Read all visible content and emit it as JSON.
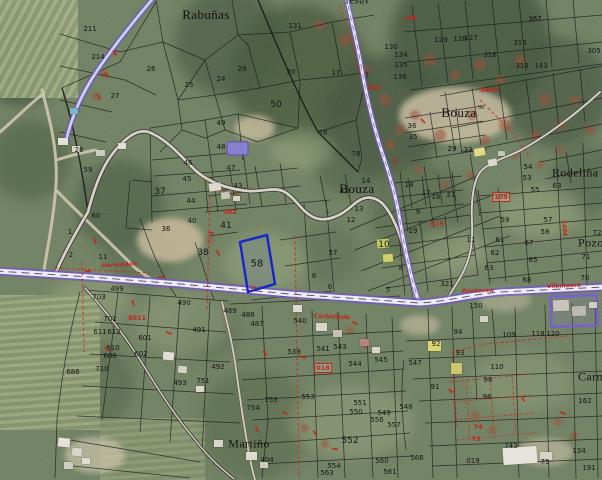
{
  "map": {
    "colors": {
      "road_purple": "#6f55c9",
      "road_fill": "#efeafc",
      "selection_blue": "#1526cc",
      "annotation_red": "#c42318",
      "parcel_line": "#1c1c1c",
      "highlight_fill": "#8b7fd6"
    },
    "place_labels": [
      {
        "t": "Rabuñas",
        "x": 206,
        "y": 15,
        "s": 13
      },
      {
        "t": "Bouza",
        "x": 459,
        "y": 113,
        "s": 13
      },
      {
        "t": "Bouza",
        "x": 357,
        "y": 189,
        "s": 13
      },
      {
        "t": "Rodeliña",
        "x": 552,
        "y": 173,
        "s": 12,
        "a": "l"
      },
      {
        "t": "Pozo",
        "x": 578,
        "y": 243,
        "s": 12,
        "a": "l"
      },
      {
        "t": "Carnés",
        "x": 578,
        "y": 377,
        "s": 12,
        "a": "l"
      },
      {
        "t": "Martiño",
        "x": 249,
        "y": 444,
        "s": 12
      },
      {
        "t": "Tesuv",
        "x": 344,
        "y": 1,
        "s": 10,
        "a": "l"
      }
    ],
    "superscripts": [
      {
        "t": "39",
        "x": 481,
        "y": 108
      }
    ],
    "parcel_numbers": [
      {
        "t": "211",
        "x": 90,
        "y": 29
      },
      {
        "t": "214",
        "x": 98,
        "y": 57
      },
      {
        "t": "26",
        "x": 151,
        "y": 69
      },
      {
        "t": "27",
        "x": 115,
        "y": 96
      },
      {
        "t": "28",
        "x": 79,
        "y": 150
      },
      {
        "t": "59",
        "x": 88,
        "y": 170
      },
      {
        "t": "60",
        "x": 96,
        "y": 216
      },
      {
        "t": "1",
        "x": 70,
        "y": 232
      },
      {
        "t": "2",
        "x": 71,
        "y": 255
      },
      {
        "t": "11",
        "x": 103,
        "y": 257
      },
      {
        "t": "25",
        "x": 189,
        "y": 85
      },
      {
        "t": "24",
        "x": 221,
        "y": 79
      },
      {
        "t": "29",
        "x": 242,
        "y": 69
      },
      {
        "t": "20",
        "x": 291,
        "y": 72
      },
      {
        "t": "17",
        "x": 336,
        "y": 73
      },
      {
        "t": "131",
        "x": 295,
        "y": 26
      },
      {
        "t": "50",
        "x": 276,
        "y": 105,
        "s": 9
      },
      {
        "t": "49",
        "x": 221,
        "y": 123
      },
      {
        "t": "48",
        "x": 221,
        "y": 147
      },
      {
        "t": "76",
        "x": 323,
        "y": 133
      },
      {
        "t": "78",
        "x": 356,
        "y": 154
      },
      {
        "t": "46",
        "x": 188,
        "y": 163
      },
      {
        "t": "45",
        "x": 187,
        "y": 179
      },
      {
        "t": "47",
        "x": 231,
        "y": 168
      },
      {
        "t": "37",
        "x": 160,
        "y": 192,
        "s": 9
      },
      {
        "t": "44",
        "x": 191,
        "y": 201
      },
      {
        "t": "40",
        "x": 192,
        "y": 221
      },
      {
        "t": "36",
        "x": 166,
        "y": 229
      },
      {
        "t": "41",
        "x": 226,
        "y": 226,
        "s": 9
      },
      {
        "t": "42",
        "x": 344,
        "y": 191
      },
      {
        "t": "43",
        "x": 238,
        "y": 186
      },
      {
        "t": "38",
        "x": 203,
        "y": 253,
        "s": 9
      },
      {
        "t": "58",
        "x": 257,
        "y": 264,
        "s": 10
      },
      {
        "t": "57",
        "x": 333,
        "y": 253
      },
      {
        "t": "8",
        "x": 314,
        "y": 276
      },
      {
        "t": "6",
        "x": 330,
        "y": 287
      },
      {
        "t": "5",
        "x": 388,
        "y": 290
      },
      {
        "t": "8",
        "x": 401,
        "y": 268
      },
      {
        "t": "14",
        "x": 366,
        "y": 181
      },
      {
        "t": "13",
        "x": 359,
        "y": 209
      },
      {
        "t": "12",
        "x": 351,
        "y": 220
      },
      {
        "t": "18",
        "x": 409,
        "y": 185
      },
      {
        "t": "17",
        "x": 426,
        "y": 193
      },
      {
        "t": "16",
        "x": 436,
        "y": 197
      },
      {
        "t": "21",
        "x": 451,
        "y": 195
      },
      {
        "t": "9",
        "x": 418,
        "y": 212
      },
      {
        "t": "19",
        "x": 413,
        "y": 231
      },
      {
        "t": "10",
        "x": 384,
        "y": 245,
        "s": 9
      },
      {
        "t": "11",
        "x": 471,
        "y": 240
      },
      {
        "t": "36",
        "x": 412,
        "y": 126
      },
      {
        "t": "35",
        "x": 413,
        "y": 137
      },
      {
        "t": "33",
        "x": 468,
        "y": 150
      },
      {
        "t": "29",
        "x": 452,
        "y": 149
      },
      {
        "t": "54",
        "x": 528,
        "y": 167
      },
      {
        "t": "53",
        "x": 527,
        "y": 178
      },
      {
        "t": "367",
        "x": 535,
        "y": 19
      },
      {
        "t": "129",
        "x": 441,
        "y": 40
      },
      {
        "t": "128",
        "x": 460,
        "y": 39
      },
      {
        "t": "127",
        "x": 471,
        "y": 38
      },
      {
        "t": "315",
        "x": 520,
        "y": 43
      },
      {
        "t": "316",
        "x": 490,
        "y": 55
      },
      {
        "t": "314",
        "x": 522,
        "y": 66
      },
      {
        "t": "143",
        "x": 541,
        "y": 66
      },
      {
        "t": "305",
        "x": 594,
        "y": 51
      },
      {
        "t": "134",
        "x": 401,
        "y": 55
      },
      {
        "t": "135",
        "x": 401,
        "y": 65
      },
      {
        "t": "136",
        "x": 400,
        "y": 77
      },
      {
        "t": "130",
        "x": 391,
        "y": 47
      },
      {
        "t": "63",
        "x": 557,
        "y": 186
      },
      {
        "t": "55",
        "x": 535,
        "y": 190
      },
      {
        "t": "59",
        "x": 505,
        "y": 220
      },
      {
        "t": "57",
        "x": 548,
        "y": 220
      },
      {
        "t": "58",
        "x": 545,
        "y": 232
      },
      {
        "t": "61",
        "x": 500,
        "y": 240
      },
      {
        "t": "67",
        "x": 529,
        "y": 243
      },
      {
        "t": "62",
        "x": 495,
        "y": 253
      },
      {
        "t": "65",
        "x": 533,
        "y": 260
      },
      {
        "t": "63",
        "x": 489,
        "y": 268
      },
      {
        "t": "72",
        "x": 597,
        "y": 233
      },
      {
        "t": "71",
        "x": 586,
        "y": 257
      },
      {
        "t": "70",
        "x": 585,
        "y": 278
      },
      {
        "t": "68",
        "x": 527,
        "y": 280
      },
      {
        "t": "321",
        "x": 447,
        "y": 284
      },
      {
        "t": "150",
        "x": 476,
        "y": 306
      },
      {
        "t": "489",
        "x": 230,
        "y": 311
      },
      {
        "t": "488",
        "x": 248,
        "y": 315
      },
      {
        "t": "487",
        "x": 257,
        "y": 324
      },
      {
        "t": "490",
        "x": 184,
        "y": 303
      },
      {
        "t": "499",
        "x": 117,
        "y": 289
      },
      {
        "t": "491",
        "x": 199,
        "y": 330
      },
      {
        "t": "492",
        "x": 218,
        "y": 367
      },
      {
        "t": "493",
        "x": 180,
        "y": 383
      },
      {
        "t": "751",
        "x": 203,
        "y": 381
      },
      {
        "t": "753",
        "x": 271,
        "y": 400
      },
      {
        "t": "754",
        "x": 253,
        "y": 408
      },
      {
        "t": "703",
        "x": 99,
        "y": 297
      },
      {
        "t": "702",
        "x": 110,
        "y": 319
      },
      {
        "t": "611",
        "x": 100,
        "y": 332
      },
      {
        "t": "612",
        "x": 114,
        "y": 332
      },
      {
        "t": "610",
        "x": 113,
        "y": 348
      },
      {
        "t": "608",
        "x": 110,
        "y": 356
      },
      {
        "t": "601",
        "x": 145,
        "y": 338
      },
      {
        "t": "602",
        "x": 141,
        "y": 354
      },
      {
        "t": "686",
        "x": 73,
        "y": 372
      },
      {
        "t": "710",
        "x": 102,
        "y": 369
      },
      {
        "t": "540",
        "x": 300,
        "y": 321
      },
      {
        "t": "539",
        "x": 294,
        "y": 352
      },
      {
        "t": "541",
        "x": 323,
        "y": 349
      },
      {
        "t": "543",
        "x": 340,
        "y": 347
      },
      {
        "t": "544",
        "x": 355,
        "y": 364
      },
      {
        "t": "545",
        "x": 381,
        "y": 360
      },
      {
        "t": "553",
        "x": 308,
        "y": 397
      },
      {
        "t": "551",
        "x": 360,
        "y": 403
      },
      {
        "t": "550",
        "x": 356,
        "y": 412
      },
      {
        "t": "549",
        "x": 384,
        "y": 413
      },
      {
        "t": "556",
        "x": 377,
        "y": 420
      },
      {
        "t": "557",
        "x": 394,
        "y": 425
      },
      {
        "t": "552",
        "x": 350,
        "y": 441,
        "s": 9
      },
      {
        "t": "560",
        "x": 382,
        "y": 461
      },
      {
        "t": "561",
        "x": 390,
        "y": 472
      },
      {
        "t": "563",
        "x": 327,
        "y": 473
      },
      {
        "t": "554",
        "x": 334,
        "y": 466
      },
      {
        "t": "404",
        "x": 267,
        "y": 460
      },
      {
        "t": "566",
        "x": 417,
        "y": 458
      },
      {
        "t": "548",
        "x": 406,
        "y": 407
      },
      {
        "t": "547",
        "x": 415,
        "y": 363
      },
      {
        "t": "94",
        "x": 458,
        "y": 332
      },
      {
        "t": "92",
        "x": 436,
        "y": 344
      },
      {
        "t": "93",
        "x": 460,
        "y": 353
      },
      {
        "t": "91",
        "x": 435,
        "y": 387
      },
      {
        "t": "110",
        "x": 497,
        "y": 367
      },
      {
        "t": "98",
        "x": 488,
        "y": 380
      },
      {
        "t": "96",
        "x": 487,
        "y": 397
      },
      {
        "t": "109",
        "x": 509,
        "y": 335
      },
      {
        "t": "118",
        "x": 538,
        "y": 334
      },
      {
        "t": "120",
        "x": 553,
        "y": 334
      },
      {
        "t": "162",
        "x": 585,
        "y": 401
      },
      {
        "t": "134",
        "x": 579,
        "y": 451
      },
      {
        "t": "743",
        "x": 511,
        "y": 446
      },
      {
        "t": "019",
        "x": 473,
        "y": 461
      },
      {
        "t": "75",
        "x": 545,
        "y": 462
      },
      {
        "t": "191",
        "x": 589,
        "y": 468
      }
    ],
    "red_annotations": [
      {
        "t": "138",
        "x": 410,
        "y": 18
      },
      {
        "t": "9600",
        "x": 489,
        "y": 90
      },
      {
        "t": "150",
        "x": 374,
        "y": 88
      },
      {
        "t": "002",
        "x": 230,
        "y": 212
      },
      {
        "t": "015",
        "x": 437,
        "y": 224
      },
      {
        "t": "74",
        "x": 478,
        "y": 427
      },
      {
        "t": "73",
        "x": 476,
        "y": 439
      },
      {
        "t": "5011",
        "x": 137,
        "y": 318
      }
    ],
    "red_boxed_annotations": [
      {
        "t": "018",
        "x": 323,
        "y": 368
      },
      {
        "t": "109",
        "x": 501,
        "y": 197
      }
    ],
    "road_labels": [
      {
        "t": "Hermedelo",
        "x": 120,
        "y": 265,
        "r": -3
      },
      {
        "t": "Carballeda",
        "x": 332,
        "y": 317,
        "r": 2
      },
      {
        "t": "Pontevea",
        "x": 478,
        "y": 291,
        "r": -2
      },
      {
        "t": "Vilamoure",
        "x": 564,
        "y": 286,
        "r": -2
      },
      {
        "t": "3404",
        "x": 564,
        "y": 228,
        "r": 85
      }
    ],
    "red_marks": [
      {
        "x": 92,
        "y": 240,
        "r": 70
      },
      {
        "x": 208,
        "y": 232,
        "r": 15
      },
      {
        "x": 215,
        "y": 252,
        "r": 55
      },
      {
        "x": 352,
        "y": 322,
        "r": 30
      },
      {
        "x": 300,
        "y": 356,
        "r": 20
      },
      {
        "x": 312,
        "y": 432,
        "r": 60
      },
      {
        "x": 332,
        "y": 448,
        "r": 10
      },
      {
        "x": 166,
        "y": 332,
        "r": 20
      },
      {
        "x": 130,
        "y": 302,
        "r": 70
      },
      {
        "x": 104,
        "y": 348,
        "r": 40
      },
      {
        "x": 262,
        "y": 352,
        "r": 45
      },
      {
        "x": 282,
        "y": 412,
        "r": 20
      },
      {
        "x": 254,
        "y": 428,
        "r": 65
      },
      {
        "x": 112,
        "y": 52,
        "r": 60
      },
      {
        "x": 104,
        "y": 74,
        "r": 60
      },
      {
        "x": 96,
        "y": 96,
        "r": 60
      },
      {
        "x": 85,
        "y": 270,
        "r": 0
      },
      {
        "x": 158,
        "y": 276,
        "r": 0
      },
      {
        "x": 250,
        "y": 287,
        "r": 0
      },
      {
        "x": 448,
        "y": 390,
        "r": 30
      },
      {
        "x": 520,
        "y": 398,
        "r": 60
      },
      {
        "x": 560,
        "y": 412,
        "r": 20
      },
      {
        "x": 420,
        "y": 120,
        "r": 45
      },
      {
        "x": 392,
        "y": 160,
        "r": 70
      }
    ],
    "buildings": [
      {
        "x": 209,
        "y": 183,
        "w": 12,
        "h": 8,
        "c": "#ddd9d0",
        "r": -8
      },
      {
        "x": 221,
        "y": 192,
        "w": 9,
        "h": 7,
        "c": "#c9c5ba",
        "r": -8
      },
      {
        "x": 233,
        "y": 196,
        "w": 7,
        "h": 5,
        "c": "#d8d4c8",
        "r": 0
      },
      {
        "x": 163,
        "y": 352,
        "w": 11,
        "h": 8,
        "c": "#e2ded4",
        "r": 5
      },
      {
        "x": 178,
        "y": 366,
        "w": 9,
        "h": 7,
        "c": "#d5d1c5",
        "r": 5
      },
      {
        "x": 196,
        "y": 386,
        "w": 8,
        "h": 6,
        "c": "#ddd8cc",
        "r": 0
      },
      {
        "x": 316,
        "y": 323,
        "w": 11,
        "h": 8,
        "c": "#d9d5c9",
        "r": 0
      },
      {
        "x": 333,
        "y": 330,
        "w": 9,
        "h": 7,
        "c": "#c5c1b5",
        "r": 0
      },
      {
        "x": 360,
        "y": 339,
        "w": 9,
        "h": 7,
        "c": "#b8837a",
        "r": 0
      },
      {
        "x": 377,
        "y": 239,
        "w": 12,
        "h": 9,
        "c": "#c6ca60",
        "r": -5
      },
      {
        "x": 383,
        "y": 254,
        "w": 10,
        "h": 8,
        "c": "#ced269",
        "r": -5
      },
      {
        "x": 474,
        "y": 148,
        "w": 11,
        "h": 8,
        "c": "#e0dc82",
        "r": -10
      },
      {
        "x": 488,
        "y": 159,
        "w": 9,
        "h": 7,
        "c": "#dcd8cc",
        "r": -10
      },
      {
        "x": 498,
        "y": 151,
        "w": 7,
        "h": 5,
        "c": "#c9c5b9",
        "r": 0
      },
      {
        "x": 428,
        "y": 341,
        "w": 13,
        "h": 10,
        "c": "#ddd772",
        "r": 0
      },
      {
        "x": 451,
        "y": 363,
        "w": 11,
        "h": 11,
        "c": "#cdc66b",
        "r": 0
      },
      {
        "x": 553,
        "y": 300,
        "w": 16,
        "h": 11,
        "c": "#c9c5ba",
        "r": -3
      },
      {
        "x": 572,
        "y": 306,
        "w": 14,
        "h": 10,
        "c": "#bdb9ae",
        "r": -3
      },
      {
        "x": 589,
        "y": 302,
        "w": 8,
        "h": 6,
        "c": "#d2cec2",
        "r": 0
      },
      {
        "x": 503,
        "y": 447,
        "w": 34,
        "h": 17,
        "c": "#e6e3da",
        "r": -4
      },
      {
        "x": 540,
        "y": 452,
        "w": 12,
        "h": 8,
        "c": "#d8d4c8",
        "r": 0
      },
      {
        "x": 246,
        "y": 452,
        "w": 11,
        "h": 8,
        "c": "#dfdbd1",
        "r": 0
      },
      {
        "x": 260,
        "y": 462,
        "w": 8,
        "h": 6,
        "c": "#cfcbc0",
        "r": 0
      },
      {
        "x": 58,
        "y": 438,
        "w": 12,
        "h": 9,
        "c": "#e4e1d8",
        "r": 6
      },
      {
        "x": 72,
        "y": 448,
        "w": 10,
        "h": 8,
        "c": "#d8d5cb",
        "r": 6
      },
      {
        "x": 64,
        "y": 462,
        "w": 9,
        "h": 7,
        "c": "#cfccc2",
        "r": 0
      },
      {
        "x": 82,
        "y": 458,
        "w": 8,
        "h": 6,
        "c": "#e0ddd4",
        "r": 0
      },
      {
        "x": 58,
        "y": 138,
        "w": 10,
        "h": 7,
        "c": "#e6e3da",
        "r": 0
      },
      {
        "x": 72,
        "y": 146,
        "w": 8,
        "h": 6,
        "c": "#d9d6cc",
        "r": 0
      },
      {
        "x": 96,
        "y": 150,
        "w": 9,
        "h": 6,
        "c": "#cfccc2",
        "r": 0
      },
      {
        "x": 118,
        "y": 143,
        "w": 8,
        "h": 6,
        "c": "#e2dfd6",
        "r": 0
      },
      {
        "x": 70,
        "y": 108,
        "w": 8,
        "h": 6,
        "c": "#7ab5c9",
        "r": 0
      },
      {
        "x": 293,
        "y": 305,
        "w": 9,
        "h": 7,
        "c": "#ddd9cf",
        "r": 0
      },
      {
        "x": 480,
        "y": 316,
        "w": 8,
        "h": 6,
        "c": "#d2cfc4",
        "r": 0
      },
      {
        "x": 372,
        "y": 347,
        "w": 8,
        "h": 6,
        "c": "#d8d4c8",
        "r": 0
      },
      {
        "x": 214,
        "y": 440,
        "w": 9,
        "h": 7,
        "c": "#d9d5ca",
        "r": 0
      }
    ]
  }
}
